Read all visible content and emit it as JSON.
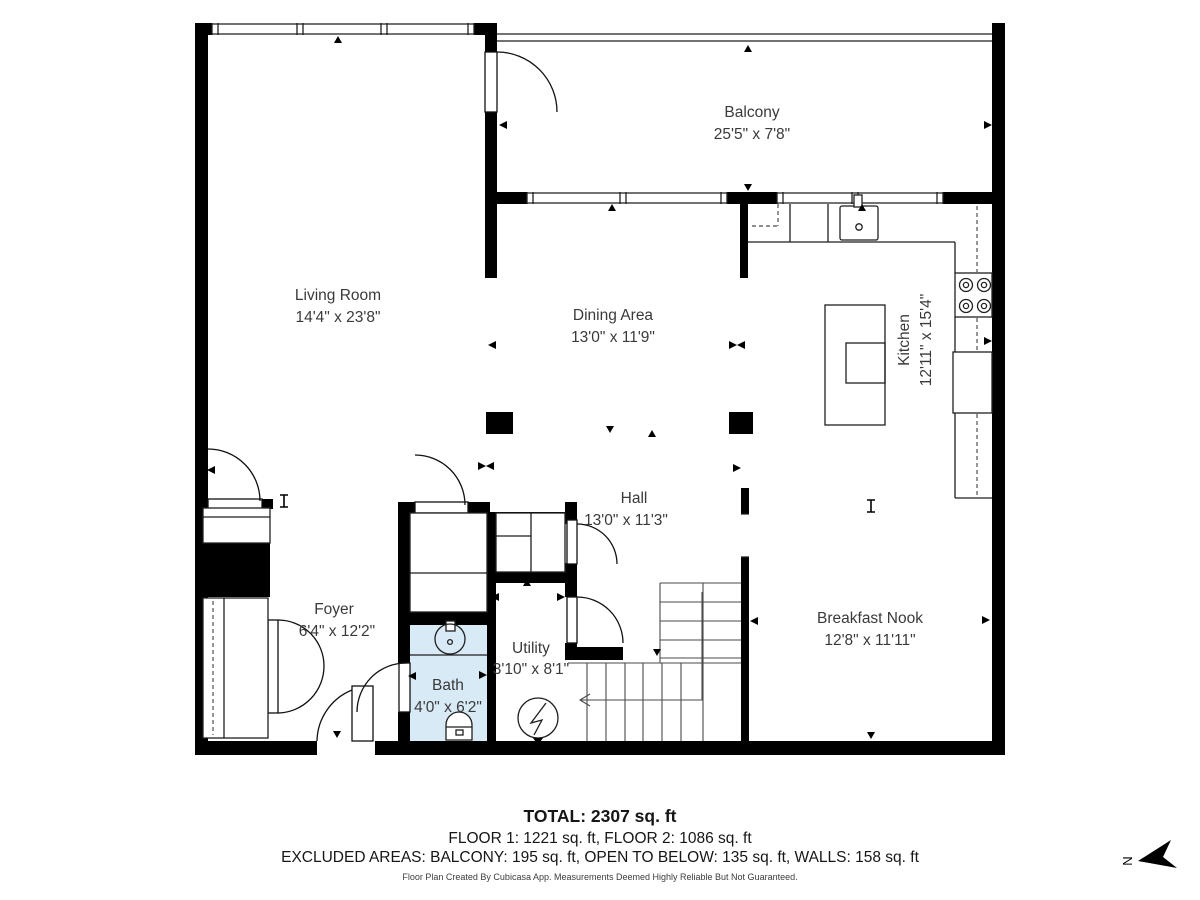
{
  "colors": {
    "wall": "#000000",
    "bath_fill": "#d8eaf6",
    "label_text": "#3a3a3a",
    "summary_text": "#161616"
  },
  "rooms": {
    "living_room": {
      "name": "Living Room",
      "dims": "14'4\" x 23'8\""
    },
    "balcony": {
      "name": "Balcony",
      "dims": "25'5\" x 7'8\""
    },
    "dining_area": {
      "name": "Dining Area",
      "dims": "13'0\" x 11'9\""
    },
    "kitchen": {
      "name": "Kitchen",
      "dims": "12'11\" x 15'4\""
    },
    "hall": {
      "name": "Hall",
      "dims": "13'0\" x 11'3\""
    },
    "foyer": {
      "name": "Foyer",
      "dims": "6'4\" x 12'2\""
    },
    "utility": {
      "name": "Utility",
      "dims": "3'10\" x 8'1\""
    },
    "bath": {
      "name": "Bath",
      "dims": "4'0\" x 6'2\""
    },
    "breakfast_nook": {
      "name": "Breakfast Nook",
      "dims": "12'8\" x 11'11\""
    }
  },
  "summary": {
    "total": "TOTAL: 2307 sq. ft",
    "floors": "FLOOR 1: 1221 sq. ft, FLOOR 2: 1086 sq. ft",
    "excluded": "EXCLUDED AREAS: BALCONY: 195 sq. ft, OPEN TO BELOW: 135 sq. ft, WALLS: 158 sq. ft",
    "disclaimer": "Floor Plan Created By Cubicasa App. Measurements Deemed Highly Reliable But Not Guaranteed."
  },
  "compass": {
    "north_label": "N"
  }
}
